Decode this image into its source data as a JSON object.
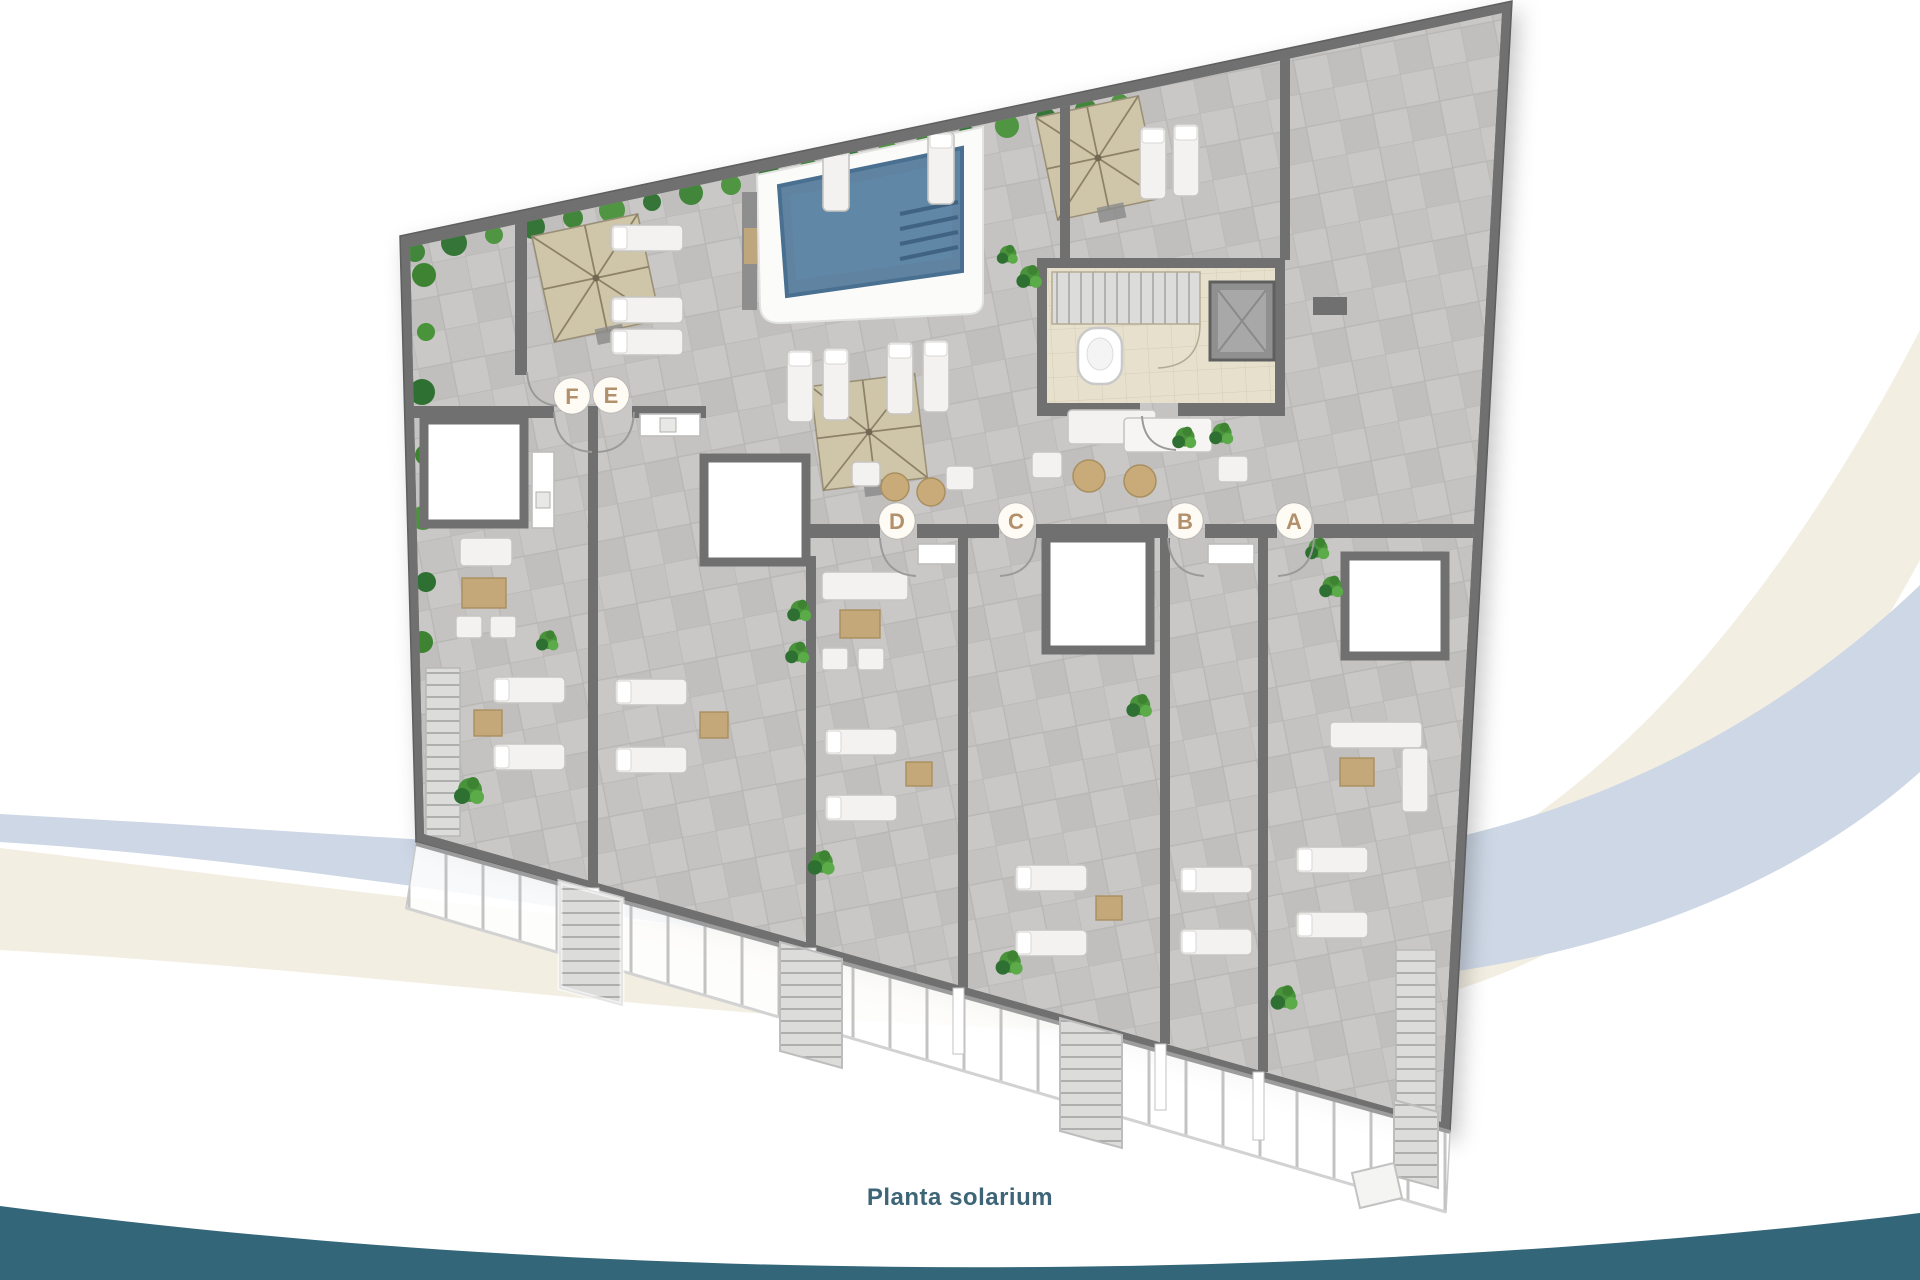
{
  "figure": {
    "caption": "Planta solarium",
    "type": "floor-plan"
  },
  "plan": {
    "unit_labels": [
      {
        "letter": "F"
      },
      {
        "letter": "E"
      },
      {
        "letter": "D"
      },
      {
        "letter": "C"
      },
      {
        "letter": "B"
      },
      {
        "letter": "A"
      }
    ],
    "features": [
      "pool",
      "parasol",
      "sun-lounger",
      "private-terrace",
      "stairs",
      "lift",
      "wc",
      "hedge",
      "railing"
    ]
  },
  "colors": {
    "caption_text": "#3e6577",
    "bottom_wave": "#336679",
    "swoosh_cream": "#f3eee2",
    "swoosh_blue": "#cdd7e5",
    "wall": "#6f6f6f",
    "tile": "#c9c8c6",
    "pool_water": "#5e83a1",
    "core_floor": "#e7e0cd",
    "parasol": "#cfc5a9",
    "plant": "#49923a",
    "label_letter": "#b3906c",
    "label_circle": "#fdfbf4"
  }
}
